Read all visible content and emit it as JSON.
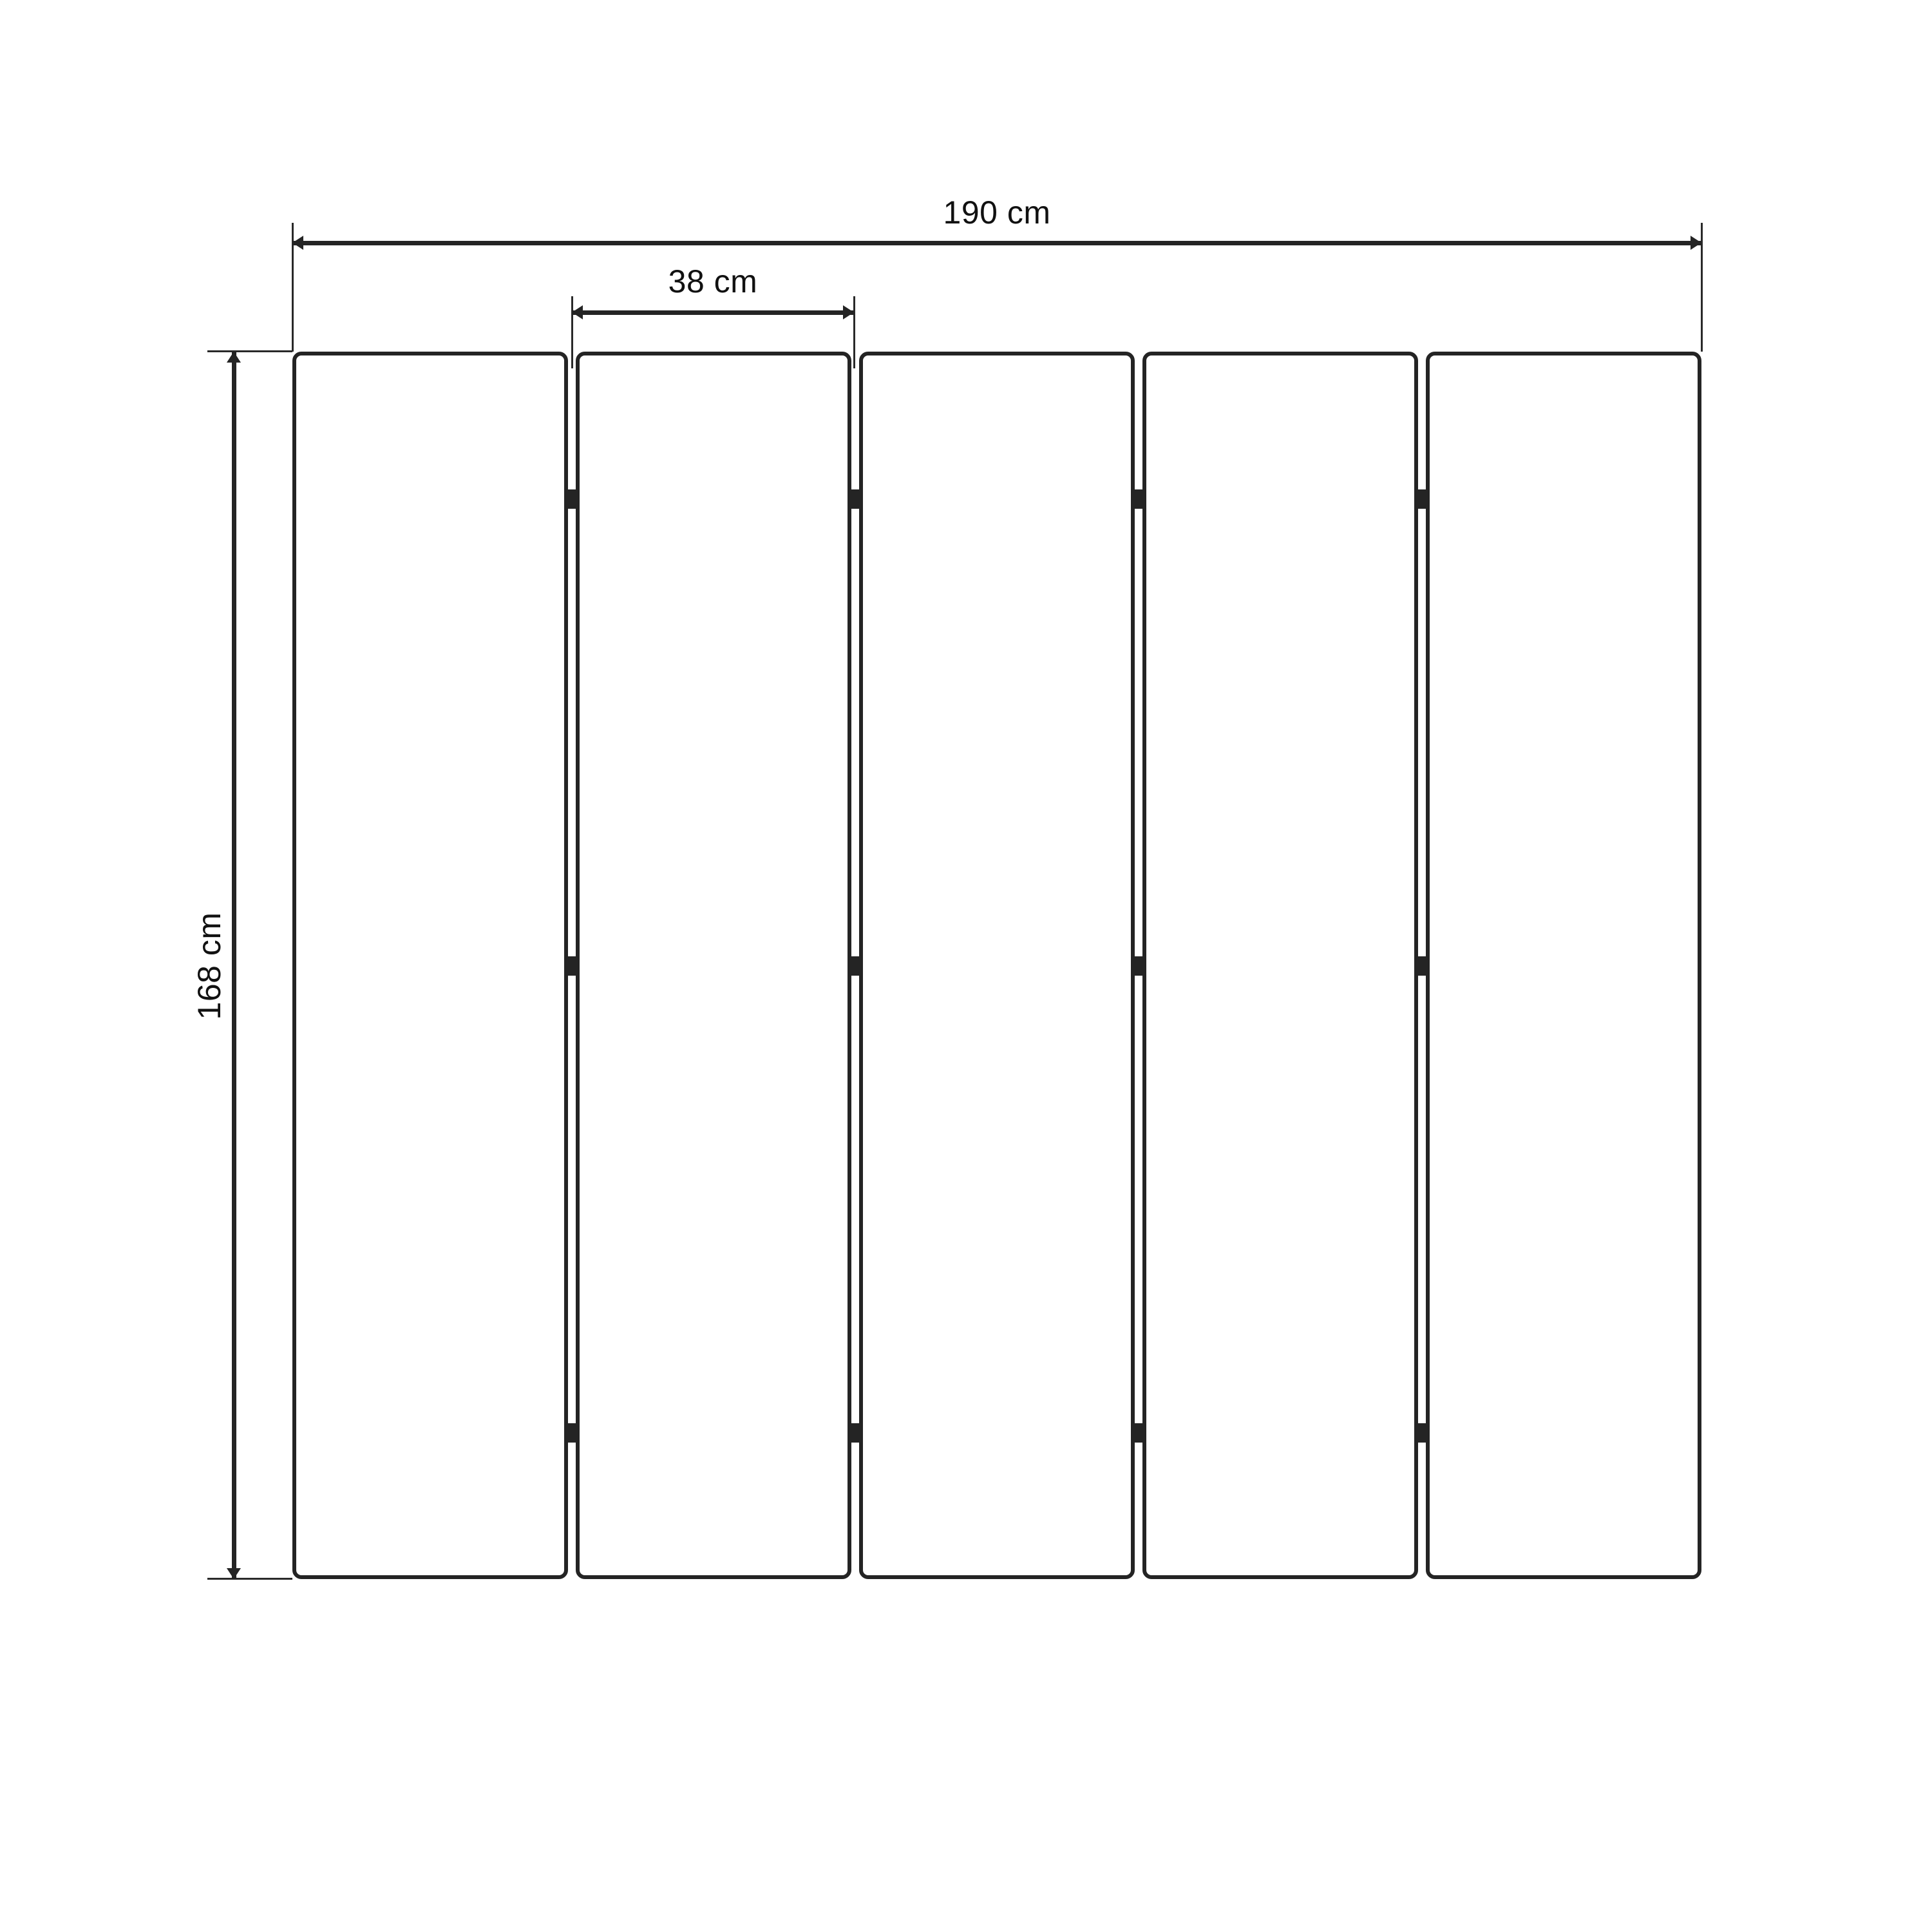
{
  "diagram": {
    "type": "furniture-dimension-drawing",
    "subject": "5-panel folding screen front view with dimensions",
    "labels": {
      "total_width": "190 cm",
      "panel_width": "38 cm",
      "height": "168 cm"
    },
    "panels": {
      "count": 5,
      "gaps": 4,
      "hinges_per_gap": 3
    },
    "colors": {
      "stroke": "#242424",
      "text": "#111111",
      "background": "#ffffff"
    }
  }
}
